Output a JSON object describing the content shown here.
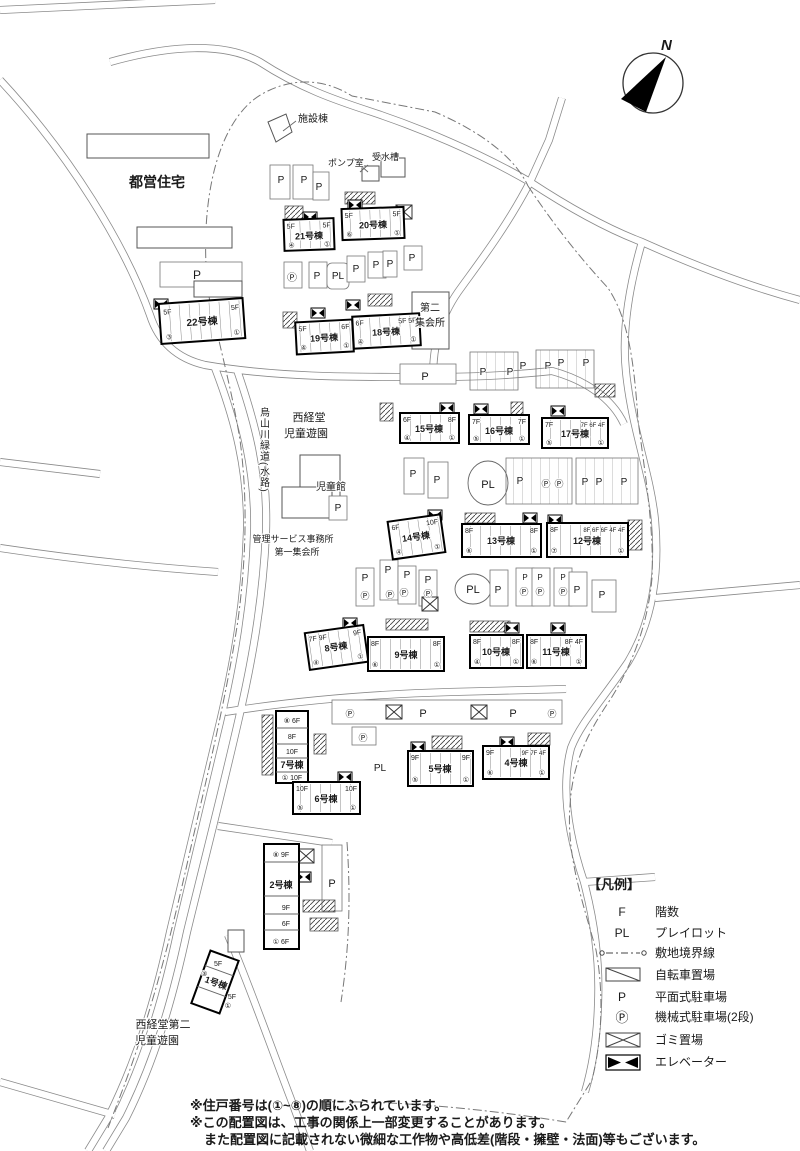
{
  "map": {
    "north": "N",
    "labels": {
      "toei": "都営住宅",
      "shisetsu": "施設棟",
      "pump": "ポンプ室",
      "tank": "受水槽",
      "greenway": "烏山川緑道(水路)",
      "park1_l1": "西経堂",
      "park1_l2": "児童遊園",
      "jidokan": "児童館",
      "office_l1": "管理サービス事務所",
      "office_l2": "第一集会所",
      "hall2_l1": "第二",
      "hall2_l2": "集会所",
      "park2_l1": "西経堂第二",
      "park2_l2": "児童遊園"
    },
    "symbols": {
      "p": "P",
      "pl": "PL",
      "pm": "Ⓟ"
    }
  },
  "buildings": {
    "b1": {
      "name": "1号棟",
      "top": "5F",
      "bottom": "5F",
      "ut": "③",
      "ub": "①"
    },
    "b2": {
      "name": "2号棟",
      "rows": [
        "⑧ 9F",
        "9F",
        "6F",
        "① 6F"
      ]
    },
    "b4": {
      "name": "4号棟",
      "fl": "9F",
      "fr": "9F 7F 4F",
      "ul": "⑥",
      "ur": "①"
    },
    "b5": {
      "name": "5号棟",
      "fl": "9F",
      "fr": "9F",
      "ul": "⑤",
      "ur": "①"
    },
    "b6": {
      "name": "6号棟",
      "fl": "10F",
      "fr": "10F",
      "ul": "⑤",
      "ur": "①"
    },
    "b7": {
      "name": "7号棟",
      "rows": [
        "⑧ 6F",
        "8F",
        "10F",
        "① 10F"
      ]
    },
    "b8": {
      "name": "8号棟",
      "fl": "7F 9F",
      "fr": "9F",
      "ul": "④",
      "ur": "①"
    },
    "b9": {
      "name": "9号棟",
      "fl": "8F",
      "fr": "8F",
      "ul": "⑥",
      "ur": "①"
    },
    "b10": {
      "name": "10号棟",
      "fl": "8F",
      "fr": "8F",
      "ul": "④",
      "ur": "①"
    },
    "b11": {
      "name": "11号棟",
      "fl": "8F",
      "fr": "8F 4F",
      "ul": "⑥",
      "ur": "①"
    },
    "b12": {
      "name": "12号棟",
      "fl": "8F",
      "fr": "8F 6F 6F 4F 4F",
      "ul": "⑦",
      "ur": "①"
    },
    "b13": {
      "name": "13号棟",
      "fl": "8F",
      "fr": "8F",
      "ul": "⑥",
      "ur": "①"
    },
    "b14": {
      "name": "14号棟",
      "fl": "6F",
      "fr": "10F",
      "ul": "④",
      "ur": "①"
    },
    "b15": {
      "name": "15号棟",
      "fl": "6F",
      "fr": "8F",
      "ul": "④",
      "ur": "①"
    },
    "b16": {
      "name": "16号棟",
      "fl": "7F",
      "fr": "7F",
      "ul": "⑤",
      "ur": "①"
    },
    "b17": {
      "name": "17号棟",
      "fl": "7F",
      "fr": "7F 6F 4F",
      "ul": "⑤",
      "ur": "①"
    },
    "b18": {
      "name": "18号棟",
      "fl": "6F",
      "fr": "5F 5F",
      "ul": "④",
      "ur": "①"
    },
    "b19": {
      "name": "19号棟",
      "fl": "5F",
      "fr": "6F",
      "ul": "④",
      "ur": "①"
    },
    "b20": {
      "name": "20号棟",
      "fl": "5F",
      "fr": "5F",
      "ul": "⑥",
      "ur": "①"
    },
    "b21": {
      "name": "21号棟",
      "fl": "5F",
      "fr": "5F",
      "ul": "④",
      "ur": "①"
    },
    "b22": {
      "name": "22号棟",
      "fl": "5F",
      "fr": "5F",
      "ul": "③",
      "ur": "①"
    }
  },
  "legend": {
    "title": "【凡例】",
    "items": [
      {
        "symbol": "F",
        "label": "階数"
      },
      {
        "symbol": "PL",
        "label": "プレイロット"
      },
      {
        "symbol": "",
        "label": "敷地境界線"
      },
      {
        "symbol": "",
        "label": "自転車置場"
      },
      {
        "symbol": "P",
        "label": "平面式駐車場"
      },
      {
        "symbol": "Ⓟ",
        "label": "機械式駐車場(2段)"
      },
      {
        "symbol": "",
        "label": "ゴミ置場"
      },
      {
        "symbol": "",
        "label": "エレベーター"
      }
    ]
  },
  "notes": [
    "※住戸番号は(①~⑧)の順にふられています。",
    "※この配置図は、工事の関係上一部変更することがあります。",
    "また配置図に記載されない微細な工作物や高低差(階段・擁壁・法面)等もございます。"
  ]
}
